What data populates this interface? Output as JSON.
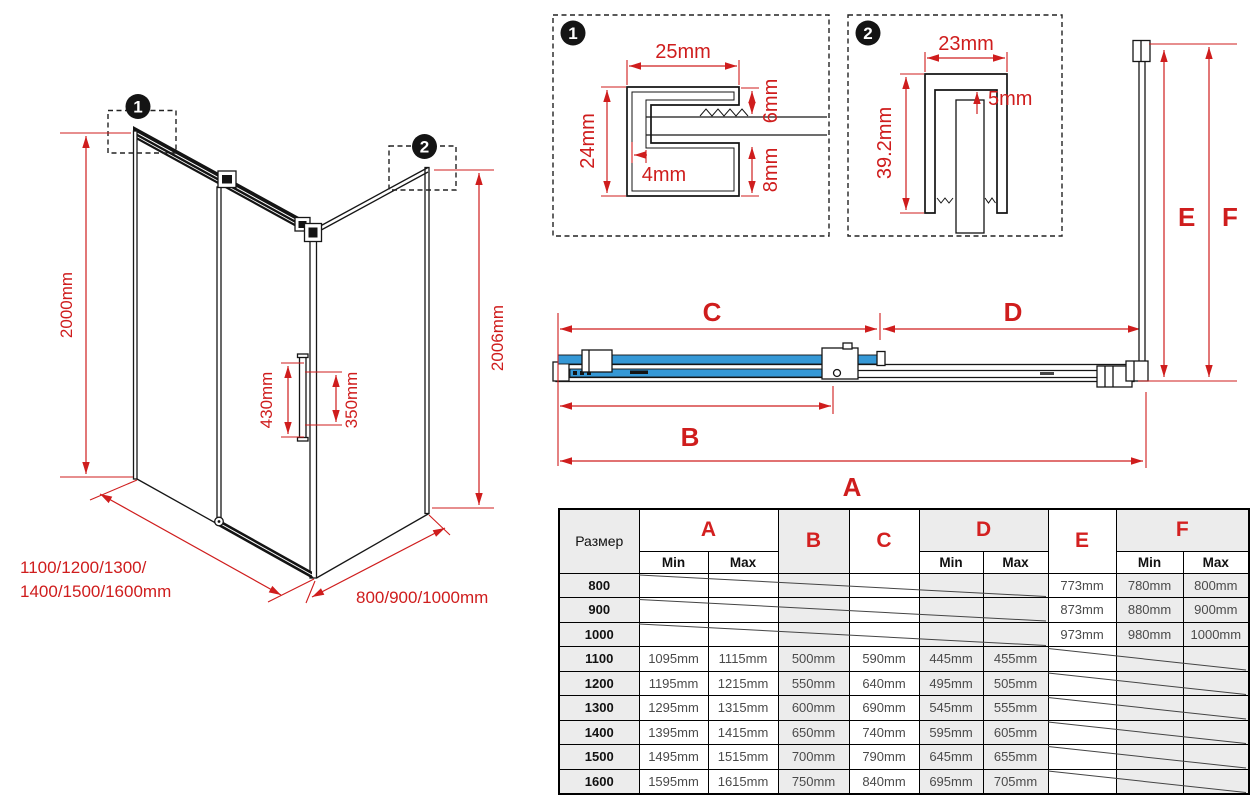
{
  "colors": {
    "red": "#cf1d1d",
    "blue": "#3598d6",
    "black": "#161616",
    "table_shade": "#ececec"
  },
  "iso": {
    "callout1": "1",
    "callout2": "2",
    "height_left": "2000mm",
    "height_right": "2006mm",
    "handle_outer": "430mm",
    "handle_inner": "350mm",
    "front_widths_line1": "1100/1200/1300/",
    "front_widths_line2": "1400/1500/1600mm",
    "side_widths": "800/900/1000mm"
  },
  "detail1": {
    "callout": "1",
    "width": "25mm",
    "height": "24mm",
    "lip": "4mm",
    "top_offset": "6mm",
    "bottom_offset": "8mm"
  },
  "detail2": {
    "callout": "2",
    "width": "23mm",
    "gap": "5mm",
    "height": "39.2mm"
  },
  "plan": {
    "a": "A",
    "b": "B",
    "c": "C",
    "d": "D",
    "e": "E",
    "f": "F"
  },
  "table": {
    "size_header": "Размер",
    "min": "Min",
    "max": "Max",
    "groups": {
      "a": "A",
      "b": "B",
      "c": "C",
      "d": "D",
      "e": "E",
      "f": "F"
    },
    "rows": [
      {
        "size": "800",
        "cells": [
          "",
          "",
          "",
          "",
          "",
          "",
          "773mm",
          "780mm",
          "800mm"
        ]
      },
      {
        "size": "900",
        "cells": [
          "",
          "",
          "",
          "",
          "",
          "",
          "873mm",
          "880mm",
          "900mm"
        ]
      },
      {
        "size": "1000",
        "cells": [
          "",
          "",
          "",
          "",
          "",
          "",
          "973mm",
          "980mm",
          "1000mm"
        ]
      },
      {
        "size": "1100",
        "cells": [
          "1095mm",
          "1115mm",
          "500mm",
          "590mm",
          "445mm",
          "455mm",
          "",
          "",
          ""
        ]
      },
      {
        "size": "1200",
        "cells": [
          "1195mm",
          "1215mm",
          "550mm",
          "640mm",
          "495mm",
          "505mm",
          "",
          "",
          ""
        ]
      },
      {
        "size": "1300",
        "cells": [
          "1295mm",
          "1315mm",
          "600mm",
          "690mm",
          "545mm",
          "555mm",
          "",
          "",
          ""
        ]
      },
      {
        "size": "1400",
        "cells": [
          "1395mm",
          "1415mm",
          "650mm",
          "740mm",
          "595mm",
          "605mm",
          "",
          "",
          ""
        ]
      },
      {
        "size": "1500",
        "cells": [
          "1495mm",
          "1515mm",
          "700mm",
          "790mm",
          "645mm",
          "655mm",
          "",
          "",
          ""
        ]
      },
      {
        "size": "1600",
        "cells": [
          "1595mm",
          "1615mm",
          "750mm",
          "840mm",
          "695mm",
          "705mm",
          "",
          "",
          ""
        ]
      }
    ]
  }
}
